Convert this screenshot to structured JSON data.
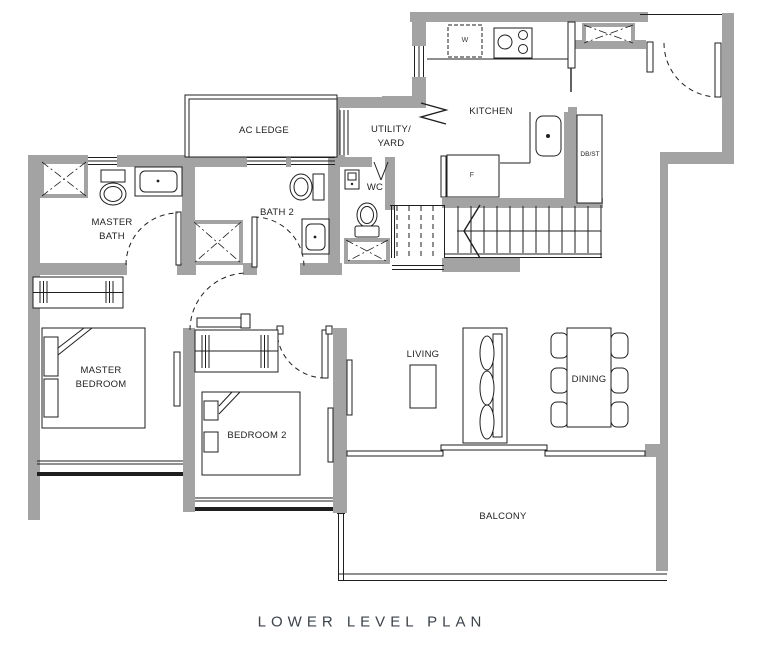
{
  "plan": {
    "title": "LOWER LEVEL PLAN",
    "rooms": {
      "ac_ledge": "AC LEDGE",
      "utility_yard": "UTILITY/\nYARD",
      "kitchen": "KITCHEN",
      "wc": "WC",
      "master_bath": "MASTER\nBATH",
      "bath_2": "BATH 2",
      "db_st": "DB/ST",
      "master_bedroom": "MASTER\nBEDROOM",
      "bedroom_2": "BEDROOM 2",
      "living": "LIVING",
      "dining": "DINING",
      "balcony": "BALCONY"
    },
    "appliances": {
      "washer": "W",
      "fridge": "F"
    },
    "colors": {
      "wall": "#a3a3a3",
      "line": "#1f1f1f",
      "title": "#3b424c",
      "background": "#ffffff"
    }
  }
}
